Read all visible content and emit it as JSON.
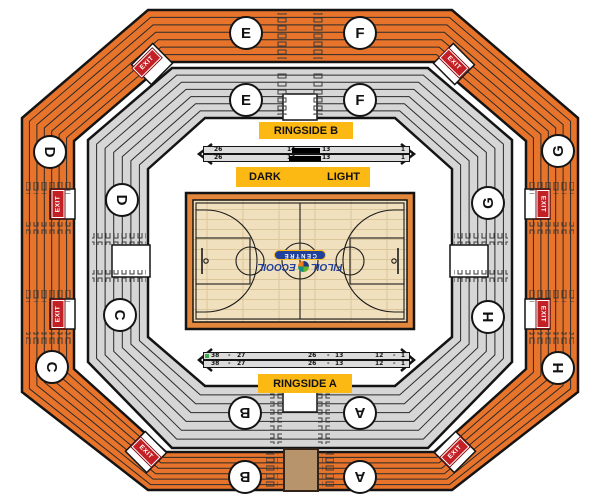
{
  "labels": {
    "ringside_b": "RINGSIDE B",
    "ringside_a": "RINGSIDE A",
    "dark": "DARK",
    "light": "LIGHT",
    "exit": "EXIT"
  },
  "sections": {
    "A": "A",
    "B": "B",
    "C": "C",
    "D": "D",
    "E": "E",
    "F": "F",
    "G": "G",
    "H": "H"
  },
  "ringside_b": {
    "row1": [
      "26",
      "14",
      "13",
      "1"
    ],
    "row2": [
      "26",
      "14",
      "13",
      "1"
    ]
  },
  "ringside_a": {
    "row1": [
      "38",
      "-",
      "27",
      "26",
      "-",
      "13",
      "12",
      "-",
      "1"
    ],
    "row2": [
      "38",
      "-",
      "27",
      "26",
      "-",
      "13",
      "12",
      "-",
      "1"
    ]
  },
  "logo": {
    "filoil": "FILOIL",
    "ecooil": "ECOOIL",
    "centre": "CENTRE"
  },
  "colors": {
    "upper_bowl_orange": "#E8742C",
    "lower_bowl_gray": "#D6D6D6",
    "label_yellow": "#FCB813",
    "exit_red": "#C32026",
    "court_wood": "#F1E0BE",
    "court_border": "#E2873B",
    "logo_navy": "#21409A",
    "marker_green": "#3DAE49"
  }
}
